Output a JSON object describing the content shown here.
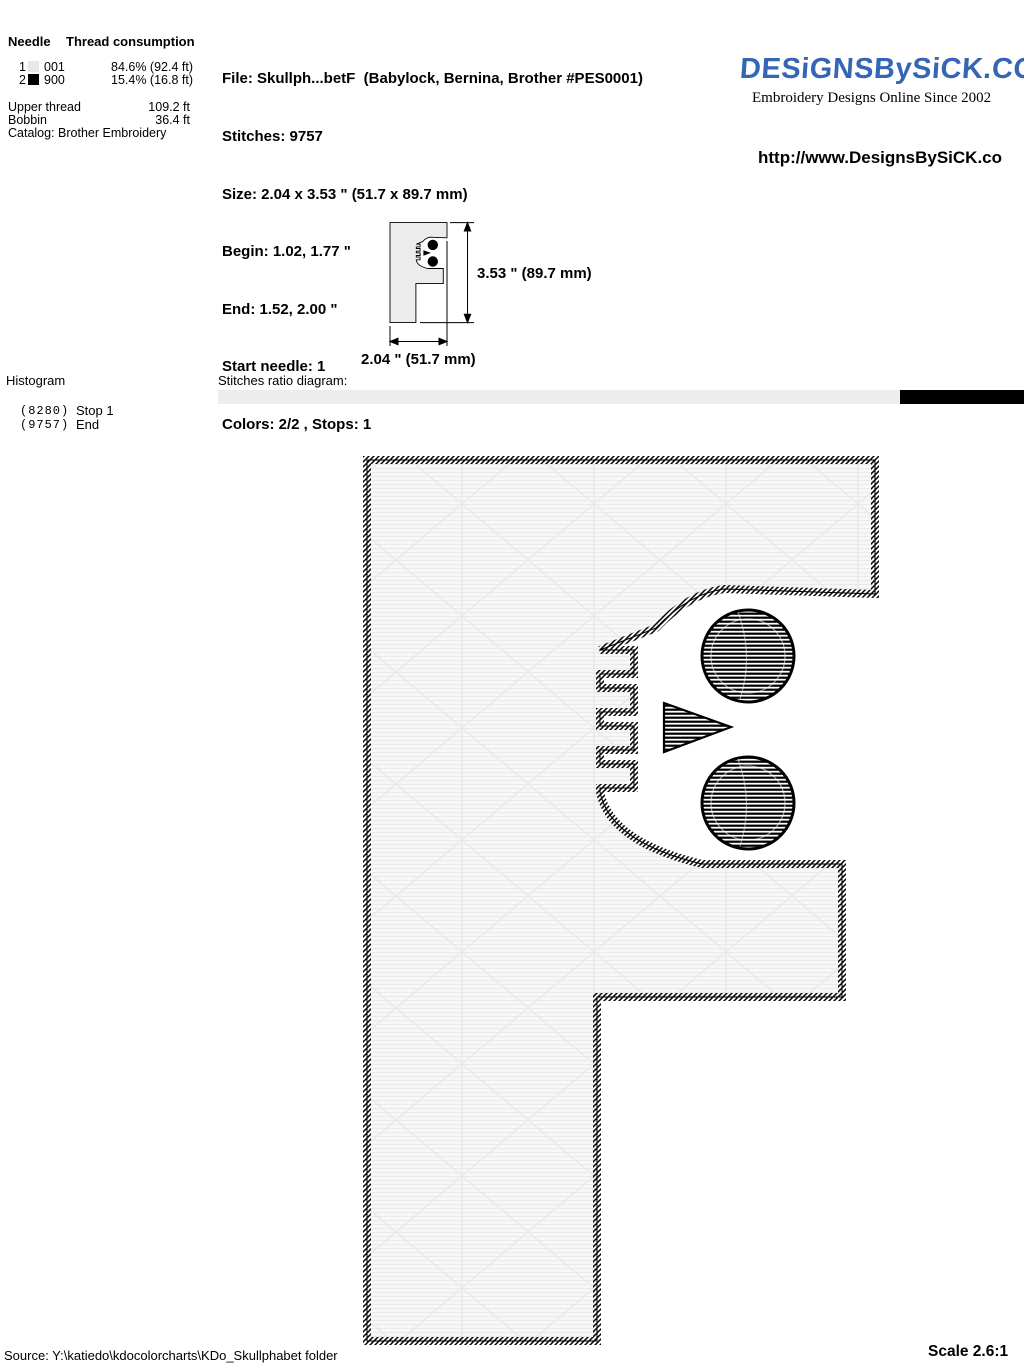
{
  "needle_table": {
    "header": {
      "col_needle": "Needle",
      "col_consumption": "Thread consumption"
    },
    "rows": [
      {
        "needle": "1",
        "swatch": "#e8e8e8",
        "code": "001",
        "consumption": "84.6% (92.4 ft)"
      },
      {
        "needle": "2",
        "swatch": "#000000",
        "code": "900",
        "consumption": "15.4% (16.8 ft)"
      }
    ],
    "upper_thread": {
      "label": "Upper thread",
      "value": "109.2 ft"
    },
    "bobbin": {
      "label": "Bobbin",
      "value": "36.4 ft"
    },
    "catalog": "Catalog: Brother Embroidery"
  },
  "file_info": {
    "lines": [
      "File: Skullph...betF  (Babylock, Bernina, Brother #PES0001)",
      "Stitches: 9757",
      "Size: 2.04 x 3.53 \" (51.7 x 89.7 mm)",
      "Begin: 1.02, 1.77 \"",
      "End: 1.52, 2.00 \"",
      "Start needle: 1",
      "Colors: 2/2 , Stops: 1"
    ]
  },
  "brand": {
    "logo_text": "DESiGNSBySiCK.COM",
    "logo_color": "#3566b5",
    "tagline": "Embroidery Designs Online Since 2002",
    "url": "http://www.DesignsBySiCK.co"
  },
  "size_diagram": {
    "height_label": "3.53 \" (89.7 mm)",
    "width_label": "2.04 \" (51.7 mm)"
  },
  "histogram": {
    "title": "Histogram",
    "rows": [
      {
        "count": "(8280)",
        "label": "Stop 1"
      },
      {
        "count": "(9757)",
        "label": "End"
      }
    ]
  },
  "stitches_ratio": {
    "label": "Stitches ratio diagram:",
    "segments": [
      {
        "color": "#ededed",
        "percent": 84.6
      },
      {
        "color": "#000000",
        "percent": 15.4
      }
    ]
  },
  "design": {
    "letter": "F",
    "body_fill": "#f3f3f3",
    "stitch_color": "#000000"
  },
  "footer": {
    "source": "Source: Y:\\katiedo\\kdocolorcharts\\KDo_Skullphabet folder",
    "scale": "Scale 2.6:1"
  }
}
